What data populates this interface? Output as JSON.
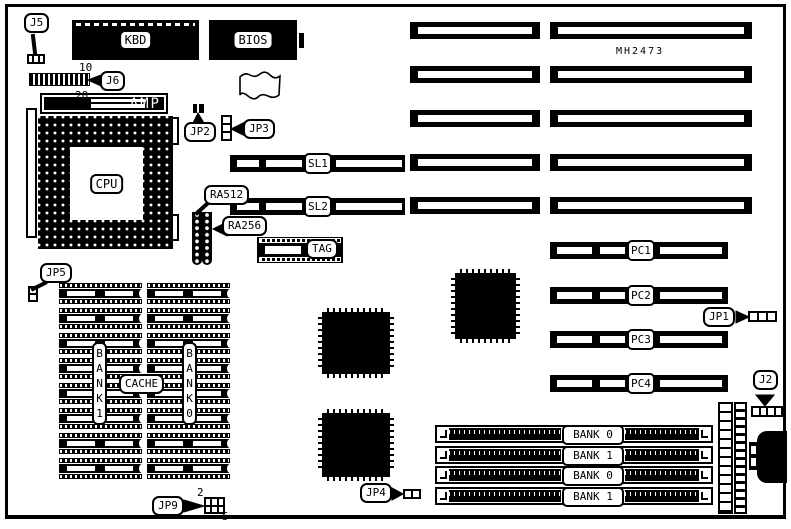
{
  "board": {
    "model": "MH2473",
    "background": "#ffffff",
    "ink": "#000000"
  },
  "chips": {
    "kbd": "KBD",
    "bios": "BIOS",
    "amp": "AMP",
    "cpu": "CPU",
    "tag": "TAG",
    "cache_label": "CACHE"
  },
  "memory": {
    "bank1_column": "BANK1",
    "bank0_column": "BANK0"
  },
  "connectors": {
    "j5": "J5",
    "j6": "J6",
    "jp2": "JP2",
    "jp3": "JP3",
    "jp5": "JP5",
    "jp9": "JP9",
    "jp4": "JP4",
    "jp1": "JP1",
    "j2": "J2",
    "ra512": "RA512",
    "ra256": "RA256"
  },
  "pin_numbers": {
    "j6_pin10": "10",
    "j6_pin20": "20",
    "jp9_pin2": "2",
    "jp9_pin5": "5"
  },
  "slots": {
    "isa_count": 5,
    "vlb": [
      "SL1",
      "SL2"
    ],
    "pc": [
      "PC1",
      "PC2",
      "PC3",
      "PC4"
    ],
    "simm": [
      "BANK 0",
      "BANK 1",
      "BANK 0",
      "BANK 1"
    ]
  }
}
